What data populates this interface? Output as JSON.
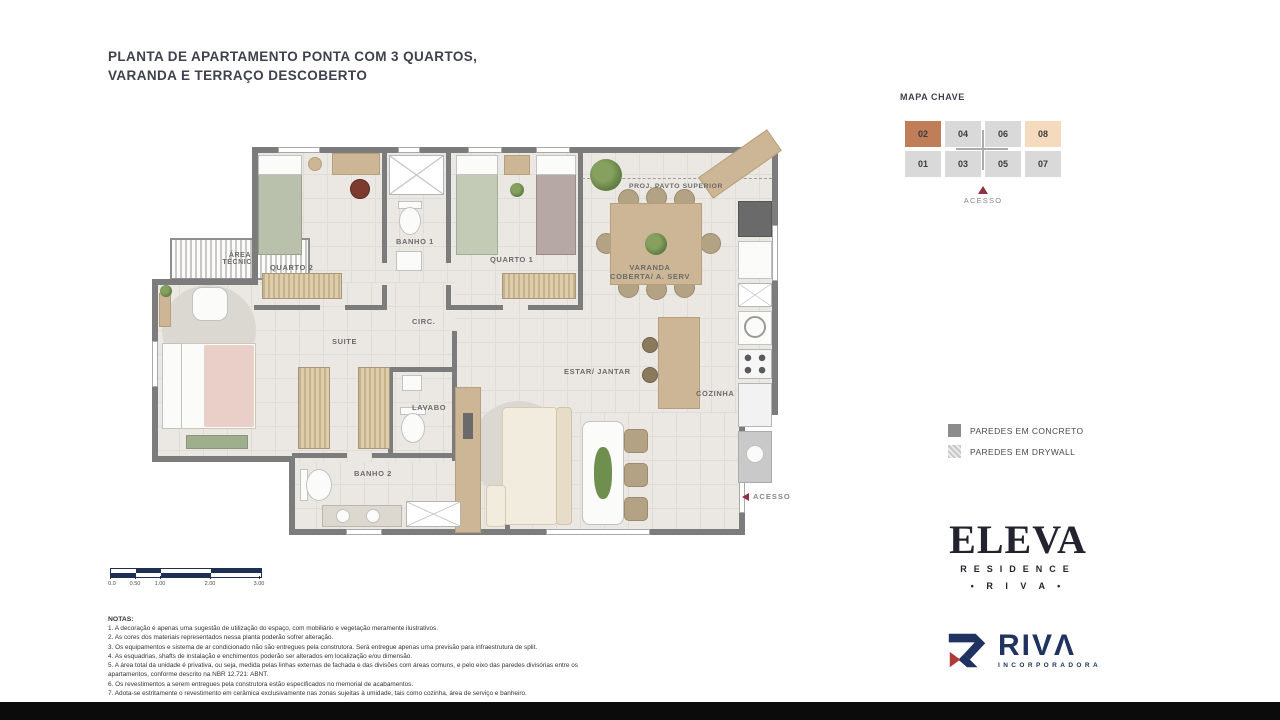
{
  "page": {
    "title_line1": "PLANTA DE APARTAMENTO PONTA COM 3 QUARTOS,",
    "title_line2": "VARANDA E TERRAÇO DESCOBERTO"
  },
  "floor_plan": {
    "rooms": {
      "quarto2": "QUARTO 2",
      "banho1": "BANHO 1",
      "quarto1": "QUARTO 1",
      "proj_pavto_superior": "PROJ. PAVTO SUPERIOR",
      "varanda_line1": "VARANDA",
      "varanda_line2": "COBERTA/ A. SERV",
      "area_tecnica_line1": "ÁREA",
      "area_tecnica_line2": "TÉCNICA",
      "circ": "CIRC.",
      "suite": "SUITE",
      "lavabo": "LAVABO",
      "banho2": "BANHO 2",
      "estar_jantar": "ESTAR/ JANTAR",
      "cozinha": "COZINHA",
      "acesso": "ACESSO"
    }
  },
  "mapa_chave": {
    "title": "MAPA CHAVE",
    "acesso": "ACESSO",
    "units": [
      {
        "num": "02",
        "highlight": "dark"
      },
      {
        "num": "04",
        "highlight": "none"
      },
      {
        "num": "06",
        "highlight": "none"
      },
      {
        "num": "08",
        "highlight": "light"
      },
      {
        "num": "01",
        "highlight": "none"
      },
      {
        "num": "03",
        "highlight": "none"
      },
      {
        "num": "05",
        "highlight": "none"
      },
      {
        "num": "07",
        "highlight": "none"
      }
    ],
    "colors": {
      "unit_highlight_dark": "#bf7e57",
      "unit_highlight_light": "#f6dabe",
      "unit_default": "#d9d9d9",
      "core": "#ababab",
      "acesso_arrow": "#8e3040"
    }
  },
  "legend": {
    "items": [
      {
        "label": "PAREDES EM CONCRETO",
        "style": "solid",
        "color": "#8c8c8c"
      },
      {
        "label": "PAREDES EM DRYWALL",
        "style": "hatch",
        "color": "#c7c7c7"
      }
    ]
  },
  "scale_bar": {
    "labels": [
      "0.0",
      "0.50",
      "1.00",
      "2.00",
      "3.00"
    ],
    "color": "#1e2f55"
  },
  "brand": {
    "eleva": "ELEVA",
    "residence": "RESIDENCE",
    "riva_dots": "• R I V A •",
    "riva_logo_text": "RIVΛ",
    "incorporadora": "INCORPORADORA",
    "navy": "#1f3260",
    "red": "#b03a38"
  },
  "notes": {
    "heading": "NOTAS:",
    "items": [
      "1. A decoração é apenas uma sugestão de utilização do espaço, com mobiliário e vegetação meramente ilustrativos.",
      "2. As cores dos materiais representados nessa planta poderão sofrer alteração.",
      "3. Os equipamentos e sistema de ar condicionado não são entregues pela construtora. Será entregue apenas uma previsão para infraestrutura de split.",
      "4. As esquadrias, shafts de instalação e enchimentos poderão ser alterados em localização e/ou dimensão.",
      "5. A área total da unidade é privativa, ou seja, medida pelas linhas externas de fachada e das divisões com áreas comuns, e pelo eixo das paredes divisórias entre os apartamentos, conforme descrito na NBR 12.721: ABNT.",
      "6. Os revestimentos a serem entregues pela construtora estão especificados no memorial de acabamentos.",
      "7. Adota-se estritamente o revestimento em cerâmica exclusivamente nas zonas sujeitas à umidade, tais como cozinha, área de serviço e banheiro."
    ]
  }
}
